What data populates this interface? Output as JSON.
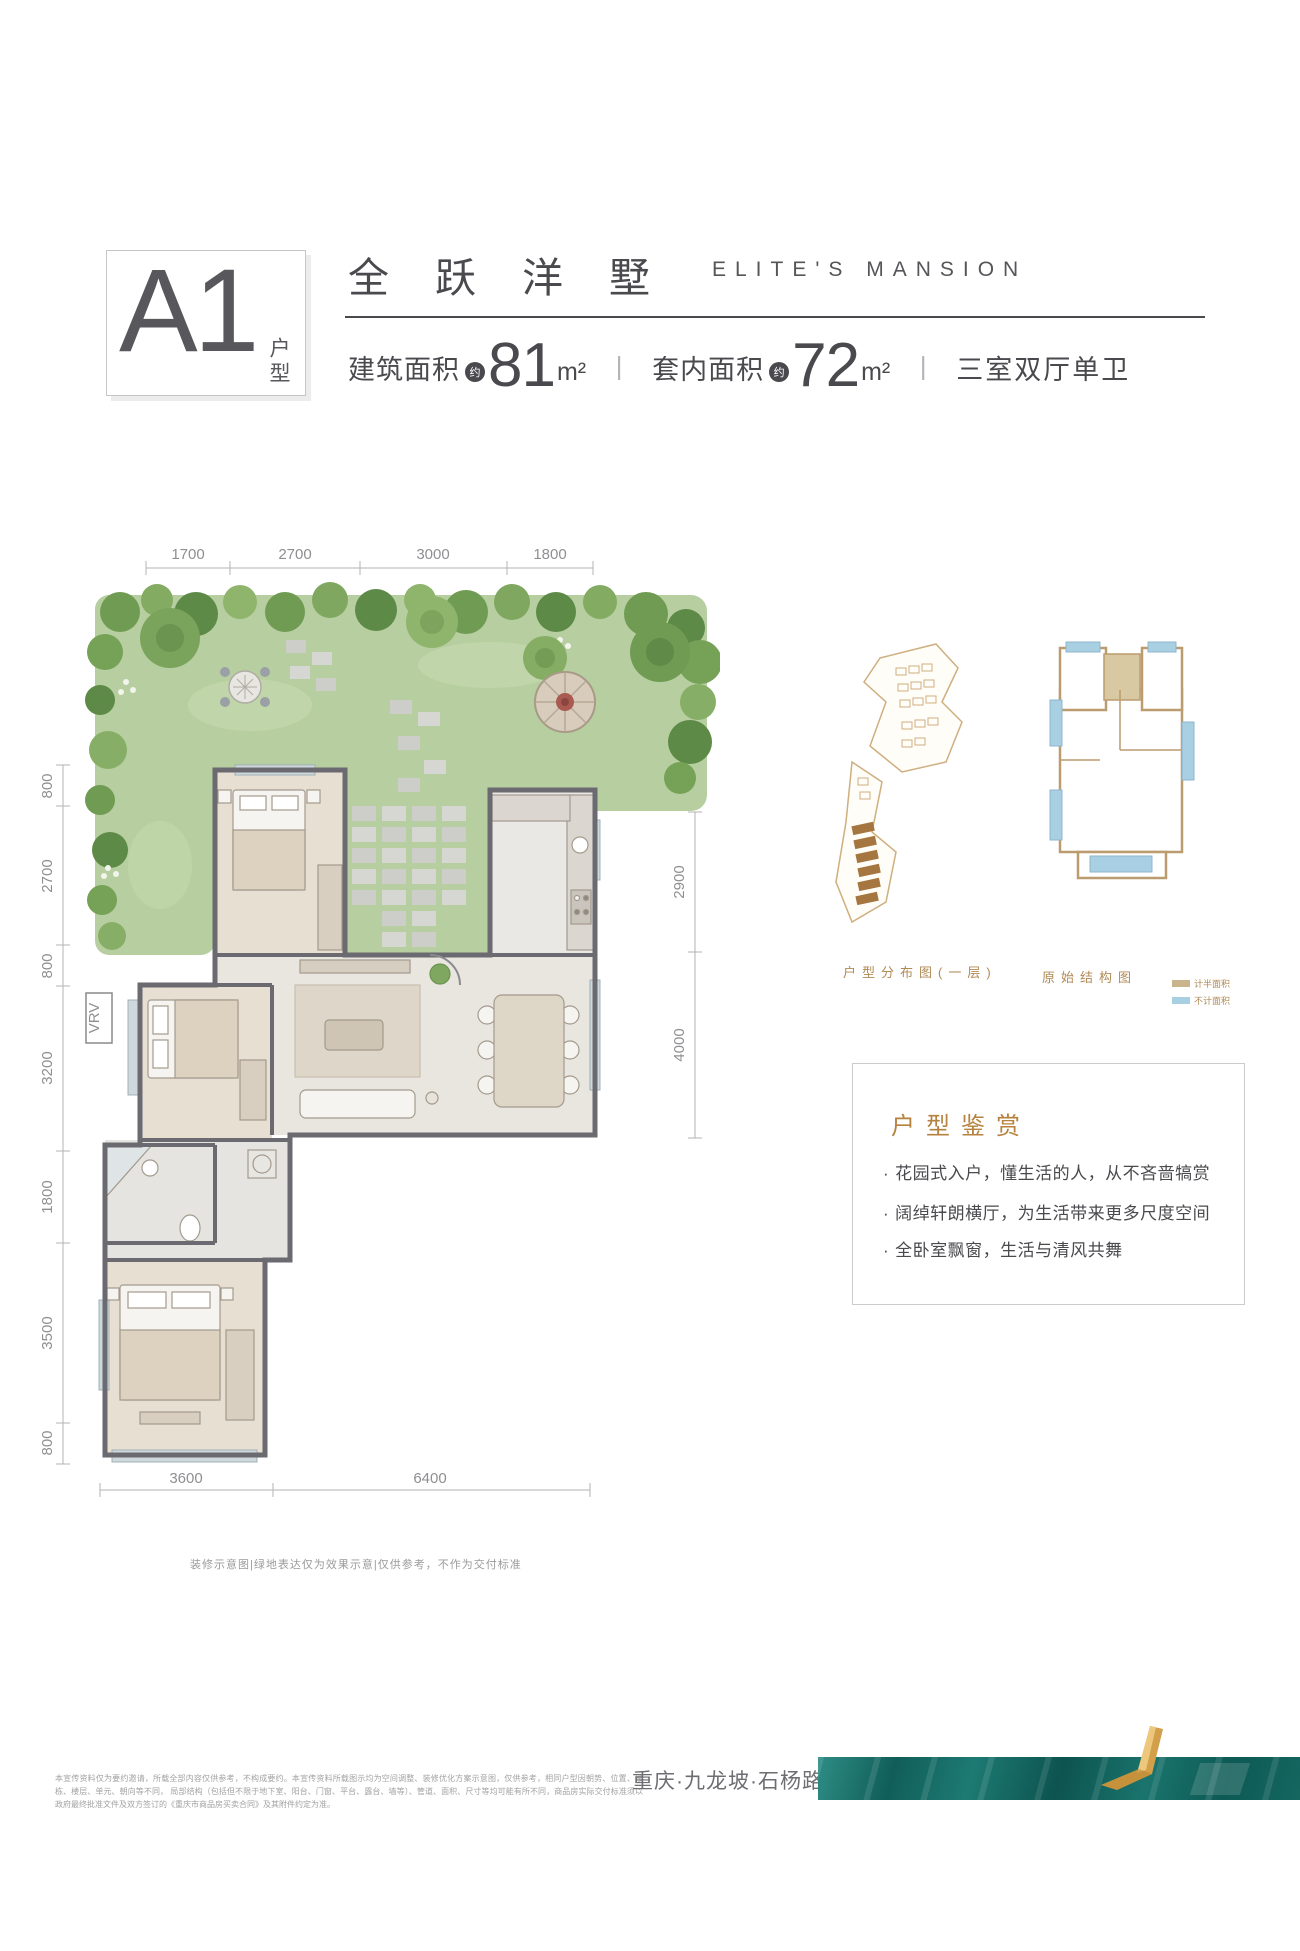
{
  "header": {
    "unit_code": "A1",
    "unit_type_label": "户型",
    "title_cn": "全跃洋墅",
    "title_en": "ELITE'S MANSION",
    "build_area_label": "建筑面积",
    "approx_label": "约",
    "build_area_value": "81",
    "build_area_unit": "m²",
    "separator": "丨",
    "inner_area_label": "套内面积",
    "inner_area_value": "72",
    "inner_area_unit": "m²",
    "layout_type": "三室双厅单卫"
  },
  "plan": {
    "dims_top": [
      "1700",
      "2700",
      "3000",
      "1800"
    ],
    "dims_left": [
      "800",
      "2700",
      "800",
      "3200",
      "1800",
      "3500",
      "800"
    ],
    "dims_right": [
      "2900",
      "4000"
    ],
    "dims_bottom": [
      "3600",
      "6400"
    ],
    "vrv_label": "VRV",
    "note": "装修示意图|绿地表达仅为效果示意|仅供参考，不作为交付标准"
  },
  "side": {
    "distribution_caption": "户型分布图(一层)",
    "structure_caption": "原始结构图",
    "legend": [
      {
        "label": "计半面积",
        "color": "#c9b48c"
      },
      {
        "label": "不计面积",
        "color": "#a9cfe2"
      }
    ],
    "appreciation": {
      "title": "户型鉴赏",
      "marker": "·",
      "bullets": [
        "花园式入户，懂生活的人，从不吝啬犒赏",
        "阔绰轩朗横厅，为生活带来更多尺度空间",
        "全卧室飘窗，生活与清风共舞"
      ]
    }
  },
  "footer": {
    "disclaimer_line1": "本宣传资料仅为要约邀请，所载全部内容仅供参考，不构成要约。本宣传资料所载图示均为空间调整、装修优化方案示意图，仅供参考，相同户型因朝势、位置、楼栋、楼层、单元、朝向等不同，",
    "disclaimer_line2": "局部结构（包括但不限于地下室、阳台、门窗、平台、露台、墙等）、管道、面积、尺寸等均可能有所不同，商品房实际交付标准须以政府最终批准文件及双方签订的《重庆市商品房买卖合同》及其附件约定为准。",
    "location": "重庆·九龙坡·石杨路"
  },
  "colors": {
    "text_dark": "#4a4a4e",
    "dim_gray": "#8f8f93",
    "accent_tan": "#b5823f",
    "garden_green": "#b7cfa0",
    "wall_gray": "#6a6a70",
    "teal": "#14665f",
    "gold": "#d8a94e",
    "legend_half": "#c9b48c",
    "legend_none": "#a9cfe2"
  }
}
